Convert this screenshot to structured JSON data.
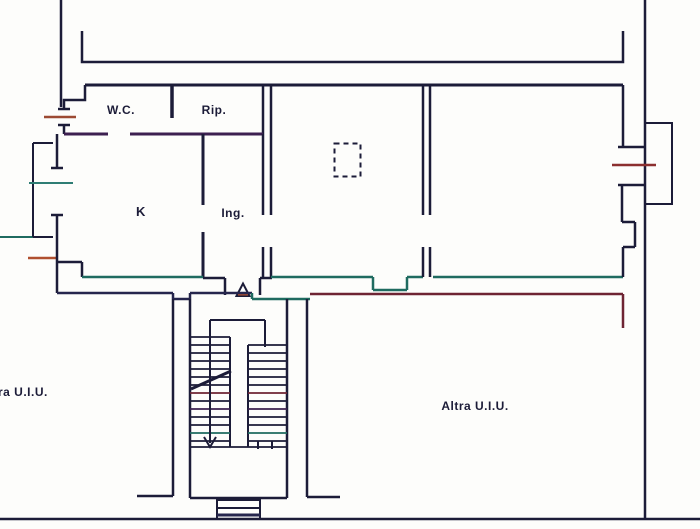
{
  "document": {
    "kind": "cadastral-floor-plan",
    "note": "scanned Italian cadastral planimetria"
  },
  "rooms": {
    "wc": {
      "label": "W.C."
    },
    "rip": {
      "label": "Rip."
    },
    "k": {
      "label": "K"
    },
    "ing": {
      "label": "Ing."
    }
  },
  "units": {
    "left": {
      "label": "ra U.I.U."
    },
    "right": {
      "label": "Altra U.I.U."
    }
  },
  "symbols": {
    "entrance_triangle": "entrance-door marker",
    "dashed_shaft": "flue/shaft dashed outline",
    "stair": "double-flight staircase with direction arrow"
  },
  "colors": {
    "ink": "#1c1c38",
    "navy": "#26264d",
    "teal": "#1f6b60",
    "maroon": "#6e2433",
    "purple": "#3d2050",
    "brown": "#9c4a33",
    "red": "#b0502f",
    "tealWindow": "#2e7d74",
    "darkred": "#8c2f2f"
  }
}
